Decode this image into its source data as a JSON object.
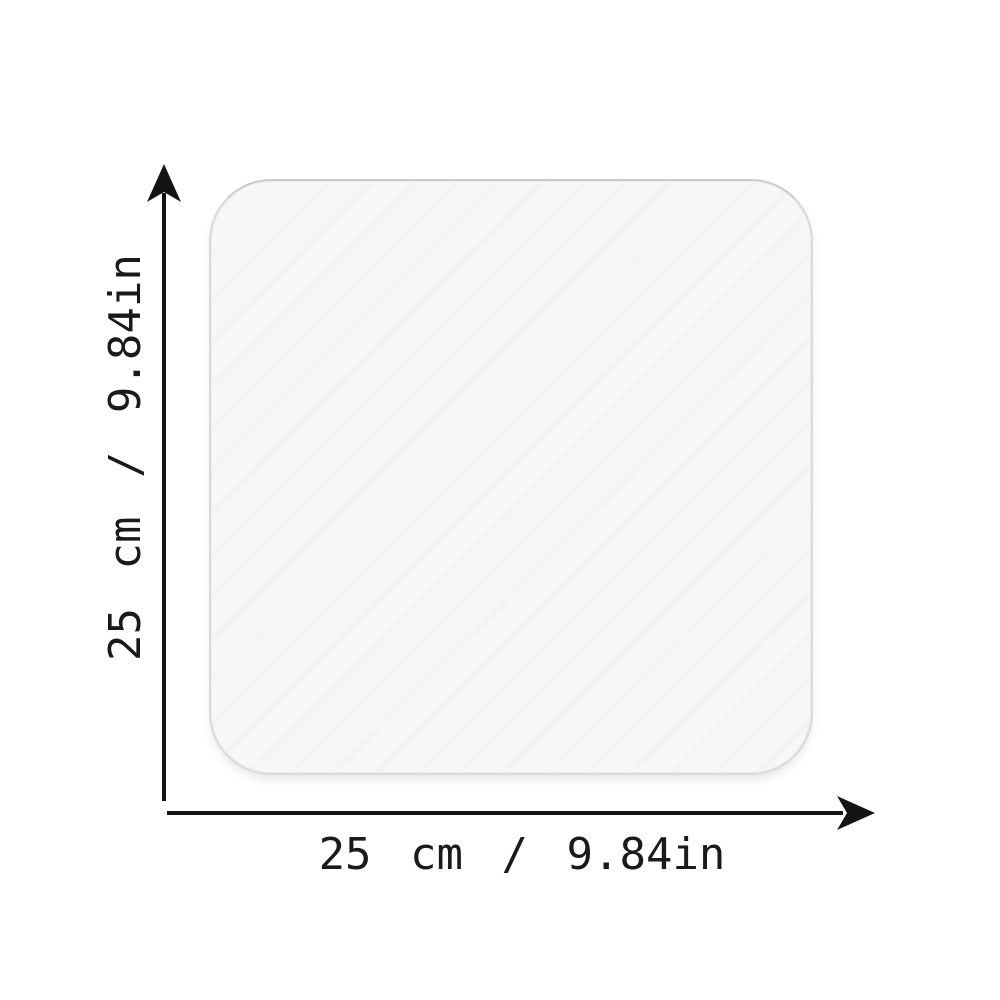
{
  "diagram": {
    "kind": "product-size-diagram",
    "product_shape": "rounded-square",
    "width_label": "25 cm / 9.84in",
    "height_label": "25 cm / 9.84in"
  },
  "icons": {
    "up_arrowhead": "up-arrowhead-icon",
    "right_arrowhead": "right-arrowhead-icon"
  },
  "colors": {
    "background": "#ffffff",
    "product_fill": "#f7f7f8",
    "product_border": "#dadada",
    "dimension_line": "#141414",
    "label_text": "#1a1a1a"
  }
}
